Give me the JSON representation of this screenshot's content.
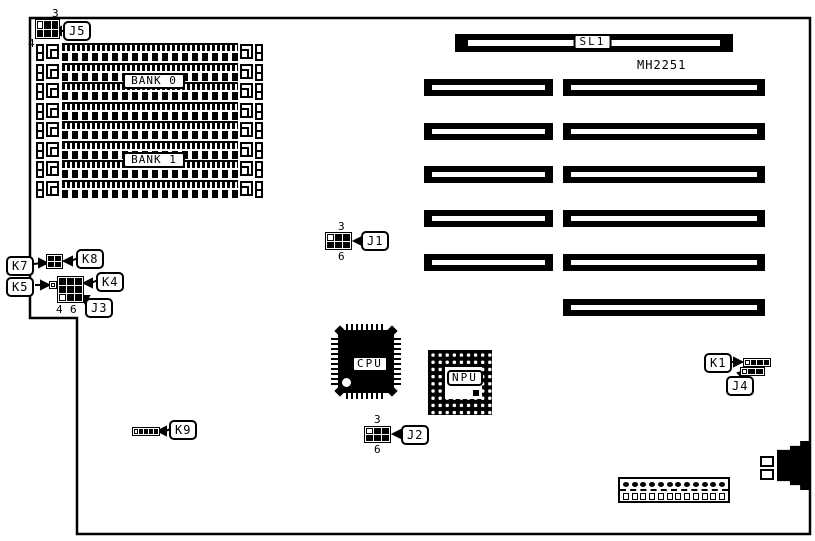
{
  "board": {
    "id_text": "MH2251"
  },
  "memory": {
    "bank0": "BANK 0",
    "bank1": "BANK 1",
    "simm_slot_count": 8
  },
  "expansion": {
    "sl1": "SL1",
    "left_column_slots": 5,
    "right_column_slots": 6
  },
  "chips": {
    "cpu": "CPU",
    "npu": "NPU"
  },
  "jumpers": {
    "j5": {
      "label": "J5",
      "pin_top": "3",
      "pin_bottom": "4"
    },
    "j1": {
      "label": "J1",
      "pin_top": "3",
      "pin_bottom": "6"
    },
    "j2": {
      "label": "J2",
      "pin_top": "3",
      "pin_bottom": "6"
    },
    "j3": {
      "label": "J3",
      "pin_a": "4",
      "pin_b": "6"
    },
    "j4": {
      "label": "J4"
    },
    "k1": {
      "label": "K1"
    },
    "k4": {
      "label": "K4"
    },
    "k5": {
      "label": "K5"
    },
    "k7": {
      "label": "K7"
    },
    "k8": {
      "label": "K8"
    },
    "k9": {
      "label": "K9"
    }
  },
  "power_connector": {
    "pin_count": 12,
    "hole_count": 12
  }
}
